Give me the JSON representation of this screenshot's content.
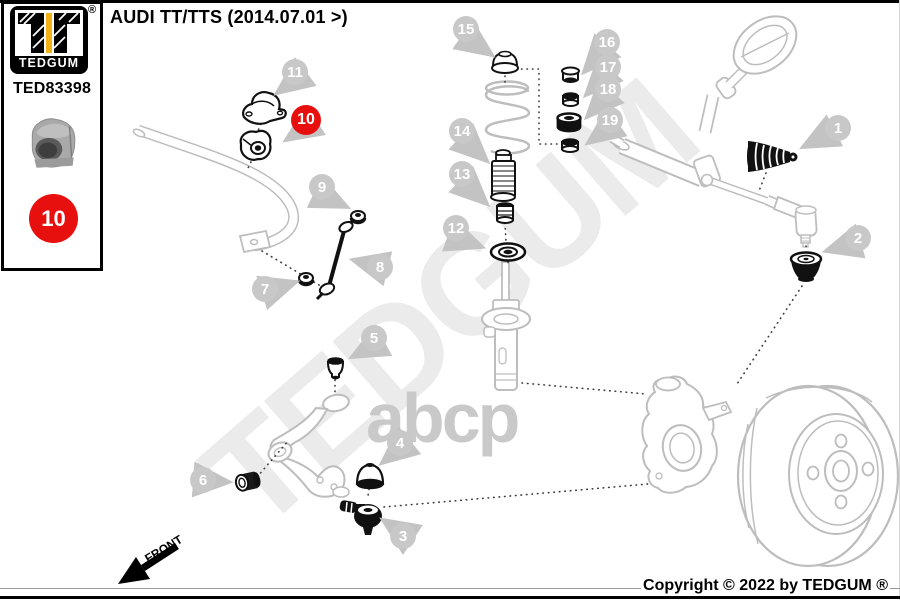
{
  "header": {
    "title": "AUDI TT/TTS (2014.07.01 >)"
  },
  "sidebar": {
    "brand": "TEDGUM",
    "registered_mark": "®",
    "part_number": "TED83398",
    "highlight_ref": "10",
    "colors": {
      "accent_yellow": "#f2b217",
      "highlight_red": "#e8100e",
      "callout_gray": "#c8c8c8"
    }
  },
  "diagram": {
    "highlighted_callout": "10",
    "callouts": [
      "1",
      "2",
      "3",
      "4",
      "5",
      "6",
      "7",
      "8",
      "9",
      "10",
      "11",
      "12",
      "13",
      "14",
      "15",
      "16",
      "17",
      "18",
      "19"
    ],
    "front_label": "FRONT"
  },
  "watermarks": {
    "diagonal": "TEDGUM",
    "center": "abcp"
  },
  "footer": {
    "copyright": "Copyright © 2022 by TEDGUM ®"
  }
}
